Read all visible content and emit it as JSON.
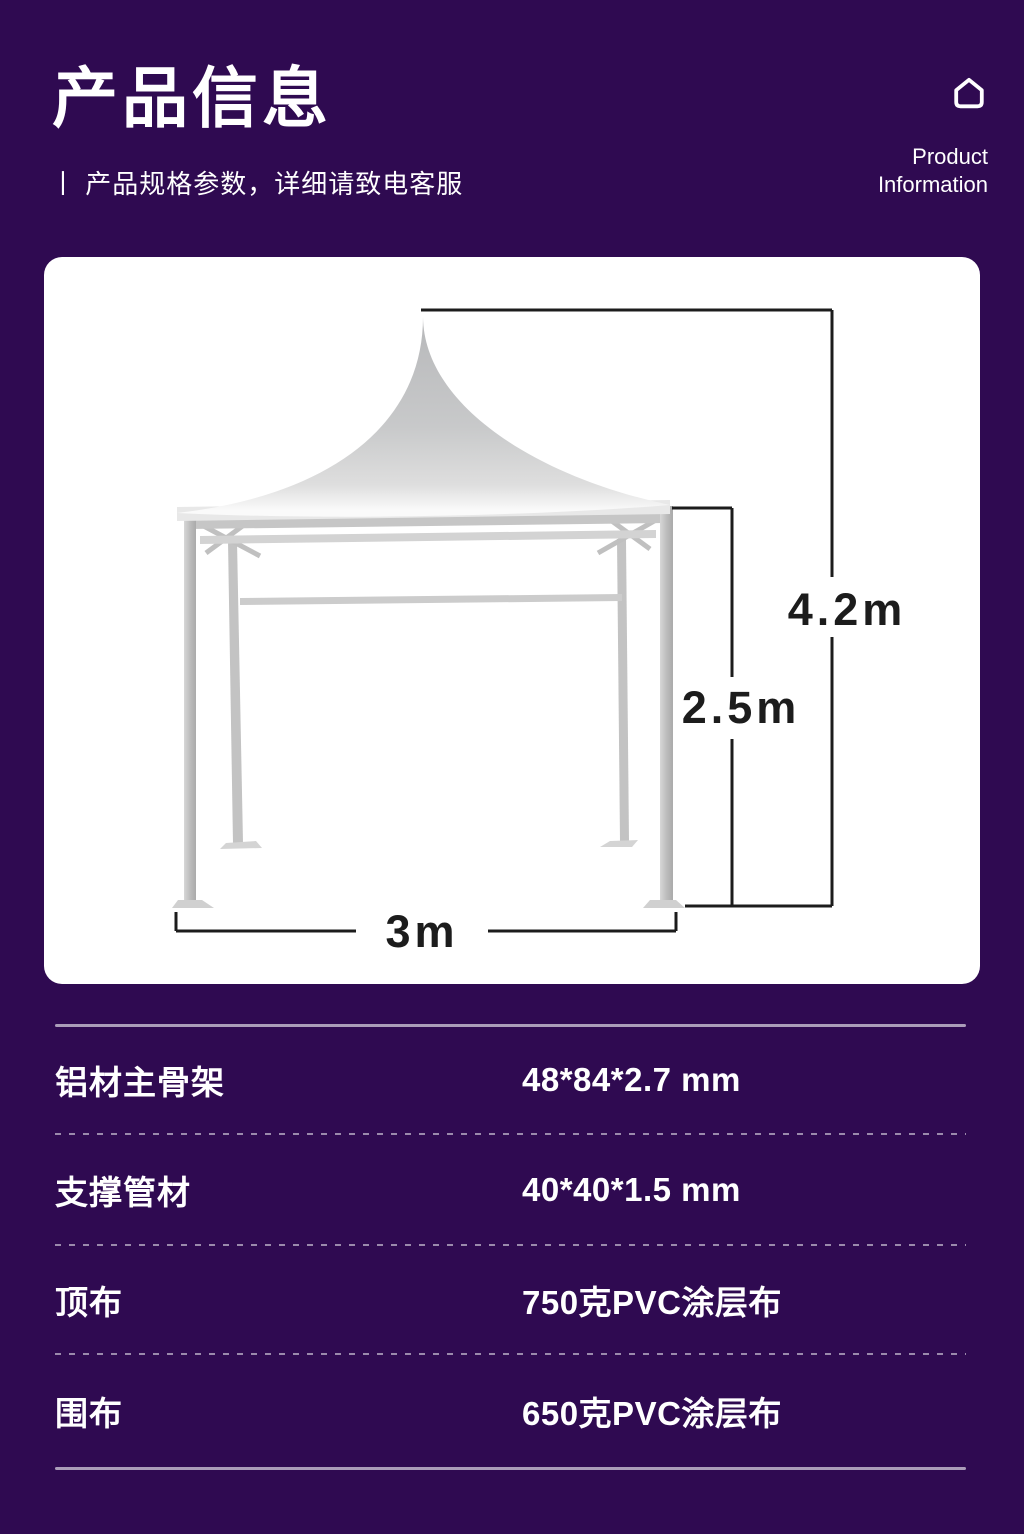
{
  "header": {
    "title": "产品信息",
    "subtitle": "丨 产品规格参数，详细请致电客服",
    "corner_icon": "home-outline-icon",
    "corner_line1": "Product",
    "corner_line2": "Information"
  },
  "diagram": {
    "subject": "pagoda-tent-dimension-drawing",
    "total_height": "4.2m",
    "eave_height": "2.5m",
    "base_width": "3m"
  },
  "specs": {
    "rows": [
      {
        "label": "铝材主骨架",
        "value": "48*84*2.7 mm"
      },
      {
        "label": "支撑管材",
        "value": "40*40*1.5 mm"
      },
      {
        "label": "顶布",
        "value": "750克PVC涂层布"
      },
      {
        "label": "围布",
        "value": "650克PVC涂层布"
      }
    ]
  },
  "colors": {
    "background": "#2f0a51",
    "card": "#ffffff",
    "text": "#ffffff",
    "dimension_line": "#1c1c1c",
    "tent_gray": "#c7c8c9",
    "separator": "rgba(255,255,255,0.55)"
  }
}
